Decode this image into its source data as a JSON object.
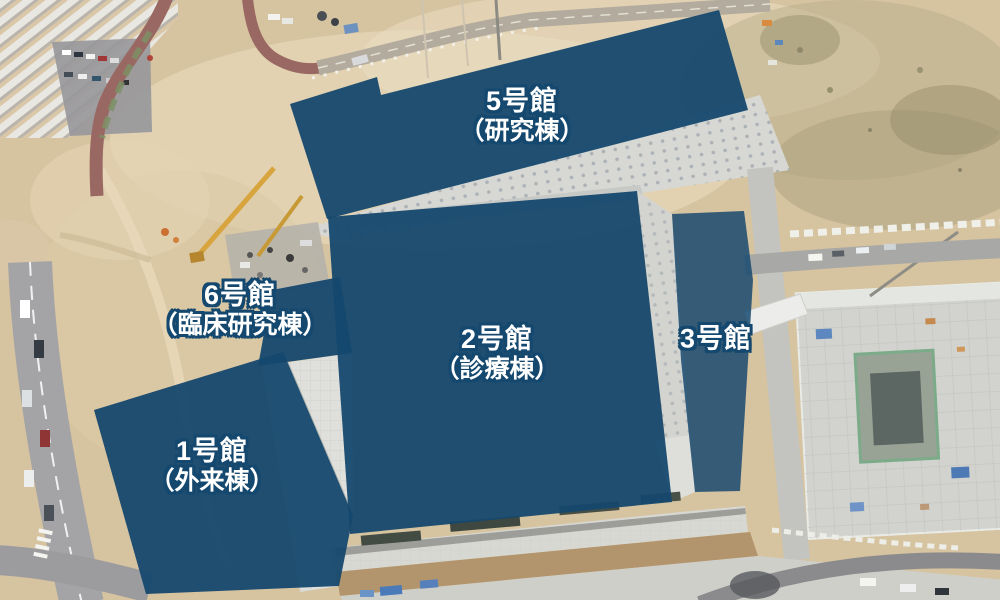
{
  "colors": {
    "overlay": "#15486e",
    "label_text": "#ffffff",
    "label_outline": "#15486e"
  },
  "buildings": [
    {
      "id": "5",
      "label_line1": "5号館",
      "label_line2": "（研究棟）"
    },
    {
      "id": "2",
      "label_line1": "2号館",
      "label_line2": "（診療棟）"
    },
    {
      "id": "3",
      "label_line1": "3号館",
      "label_line2": ""
    },
    {
      "id": "6",
      "label_line1": "6号館",
      "label_line2": "（臨床研究棟）"
    },
    {
      "id": "1",
      "label_line1": "1号館",
      "label_line2": "（外来棟）"
    }
  ]
}
